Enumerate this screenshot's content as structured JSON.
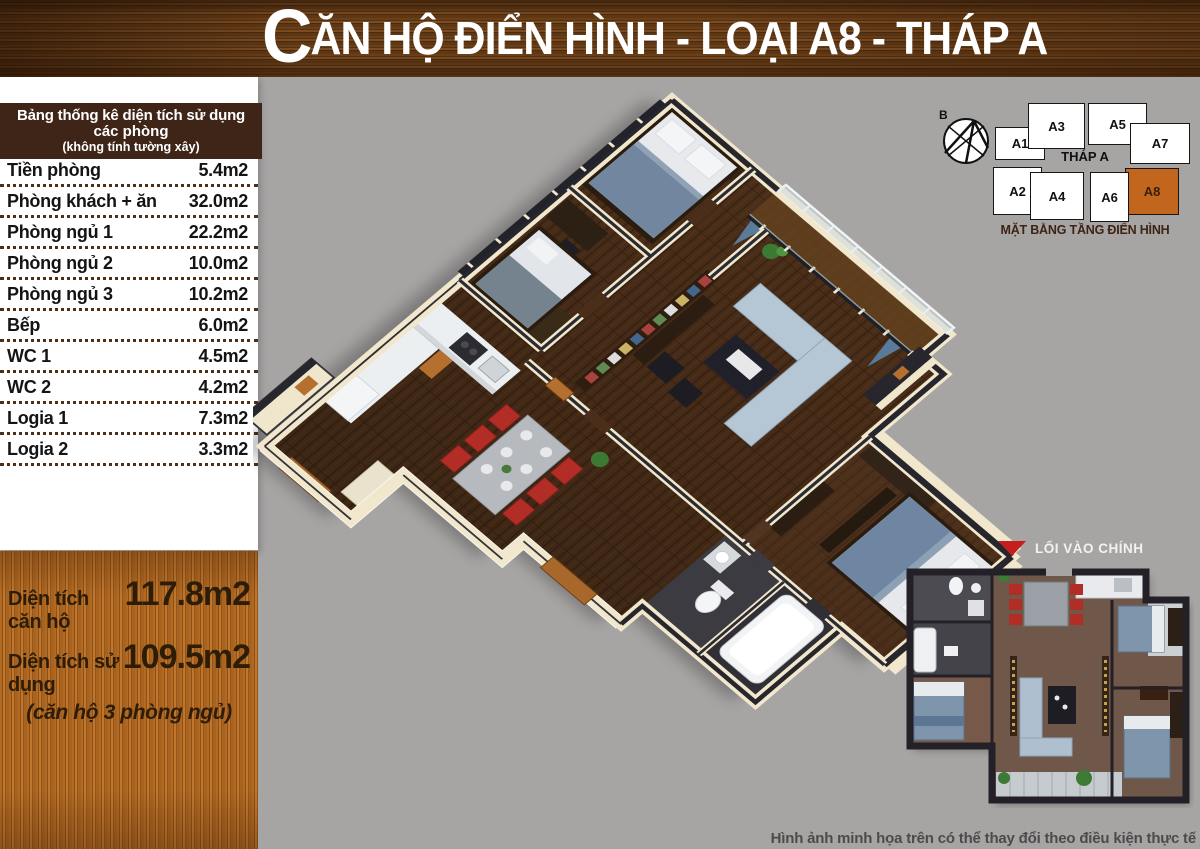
{
  "colors": {
    "background": "#a7a4a4",
    "table_header_bg": "#3f2517",
    "banner_wood": "#5e3715",
    "summary_wood": "#a86320",
    "unit_highlight": "#c2661d",
    "entrance_arrow": "#c41e1e"
  },
  "banner": {
    "title_initial": "C",
    "title_rest": "ĂN HỘ ĐIỂN HÌNH - LOẠI A8 - THÁP A"
  },
  "area_table": {
    "header_line1": "Bảng thống kê diện tích sử dụng",
    "header_line2": "các phòng",
    "header_note": "(không tính tường xây)",
    "rows": [
      {
        "label": "Tiền phòng",
        "value": "5.4m2"
      },
      {
        "label": "Phòng khách + ăn",
        "value": "32.0m2"
      },
      {
        "label": "Phòng ngủ 1",
        "value": "22.2m2"
      },
      {
        "label": "Phòng ngủ 2",
        "value": "10.0m2"
      },
      {
        "label": "Phòng ngủ 3",
        "value": "10.2m2"
      },
      {
        "label": "Bếp",
        "value": "6.0m2"
      },
      {
        "label": "WC 1",
        "value": "4.5m2"
      },
      {
        "label": "WC 2",
        "value": "4.2m2"
      },
      {
        "label": "Logia 1",
        "value": "7.3m2"
      },
      {
        "label": "Logia 2",
        "value": "3.3m2"
      }
    ]
  },
  "summary": {
    "rows": [
      {
        "label": "Diện tích căn hộ",
        "value": "117.8m2"
      },
      {
        "label": "Diện tích sử dụng",
        "value": "109.5m2"
      }
    ],
    "note": "(căn hộ 3 phòng ngủ)"
  },
  "tower_diagram": {
    "tower_label": "THÁP A",
    "caption": "MẶT BẰNG TẦNG ĐIỂN HÌNH",
    "compass_label": "B",
    "units": [
      {
        "label": "A1",
        "x": 65,
        "y": 32,
        "w": 48,
        "h": 31,
        "highlight": false
      },
      {
        "label": "A3",
        "x": 98,
        "y": 8,
        "w": 55,
        "h": 44,
        "highlight": false
      },
      {
        "label": "A5",
        "x": 158,
        "y": 8,
        "w": 57,
        "h": 40,
        "highlight": false
      },
      {
        "label": "A7",
        "x": 200,
        "y": 28,
        "w": 58,
        "h": 39,
        "highlight": false
      },
      {
        "label": "A2",
        "x": 63,
        "y": 72,
        "w": 47,
        "h": 46,
        "highlight": false
      },
      {
        "label": "A4",
        "x": 100,
        "y": 77,
        "w": 52,
        "h": 46,
        "highlight": false
      },
      {
        "label": "A8",
        "x": 195,
        "y": 73,
        "w": 52,
        "h": 45,
        "highlight": true
      },
      {
        "label": "A6",
        "x": 160,
        "y": 77,
        "w": 37,
        "h": 48,
        "highlight": false
      }
    ]
  },
  "entrance_label": {
    "text": "LỐI VÀO CHÍNH"
  },
  "disclaimer": "Hình ảnh minh họa trên có thể thay đổi theo điều kiện thực tế"
}
